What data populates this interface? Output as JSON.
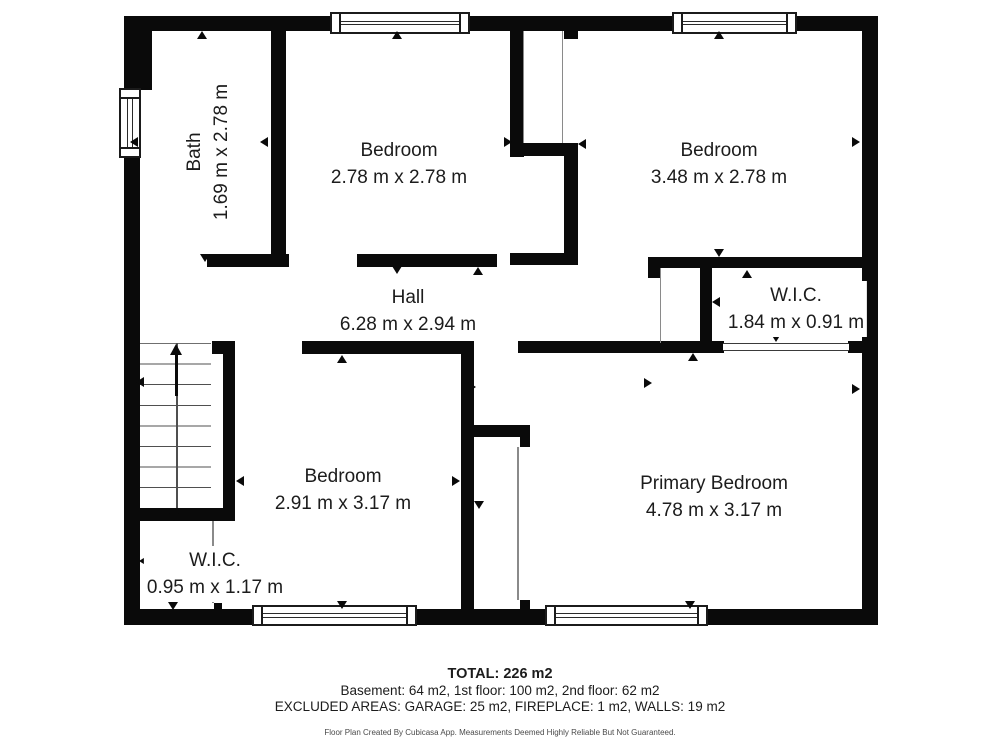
{
  "rooms": {
    "bath": {
      "name": "Bath",
      "dims": "1.69 m x 2.78 m"
    },
    "bedroom_top_left": {
      "name": "Bedroom",
      "dims": "2.78 m x 2.78 m"
    },
    "bedroom_top_right": {
      "name": "Bedroom",
      "dims": "3.48 m x 2.78 m"
    },
    "hall": {
      "name": "Hall",
      "dims": "6.28 m x 2.94 m"
    },
    "wic_upper": {
      "name": "W.I.C.",
      "dims": "1.84 m x 0.91 m"
    },
    "bedroom_lower": {
      "name": "Bedroom",
      "dims": "2.91 m x 3.17 m"
    },
    "primary_bedroom": {
      "name": "Primary Bedroom",
      "dims": "4.78 m x 3.17 m"
    },
    "wic_lower": {
      "name": "W.I.C.",
      "dims": "0.95 m x 1.17 m"
    }
  },
  "summary": {
    "total": "TOTAL: 226 m2",
    "floors": "Basement: 64 m2, 1st floor: 100 m2, 2nd floor: 62 m2",
    "excluded": "EXCLUDED AREAS: GARAGE: 25 m2, FIREPLACE: 1 m2, WALLS: 19 m2",
    "disclaimer": "Floor Plan Created By Cubicasa App. Measurements Deemed Highly Reliable But Not Guaranteed."
  },
  "colors": {
    "wall": "#0a0a0a",
    "text": "#1c1c1c",
    "disclaimer_text": "#4a4a4a",
    "background": "#ffffff"
  }
}
